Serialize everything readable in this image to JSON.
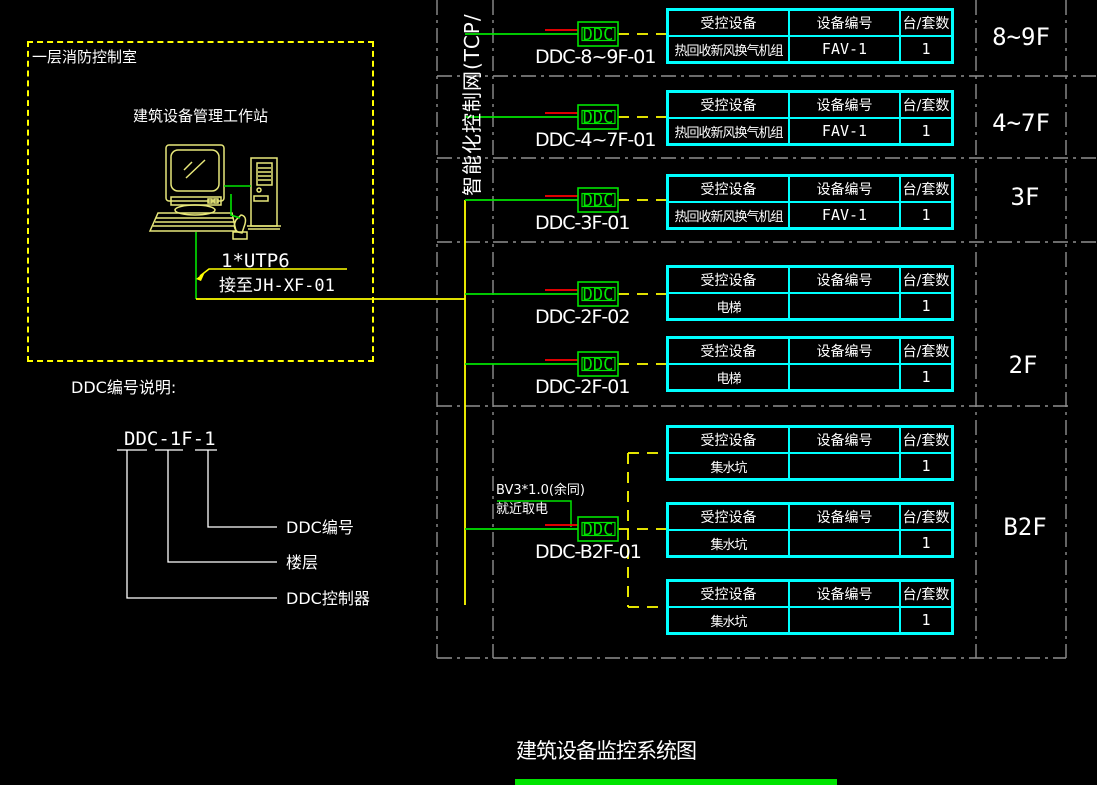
{
  "title_block": {
    "title": "建筑设备监控系统图"
  },
  "control_room": {
    "name": "一层消防控制室",
    "workstation": "建筑设备管理工作站",
    "cable": "1*UTP6",
    "connect_to": "接至JH-XF-01"
  },
  "network": {
    "trunk_label": "智能化控制网(TCP/"
  },
  "legend": {
    "heading": "DDC编号说明:",
    "example": "DDC-1F-1",
    "callouts": [
      "DDC编号",
      "楼层",
      "DDC控制器"
    ]
  },
  "power_note": {
    "line1": "BV3*1.0(余同)",
    "line2": "就近取电"
  },
  "ddc_units": [
    {
      "label": "DDC-8~9F-01",
      "box": "DDC"
    },
    {
      "label": "DDC-4~7F-01",
      "box": "DDC"
    },
    {
      "label": "DDC-3F-01",
      "box": "DDC"
    },
    {
      "label": "DDC-2F-02",
      "box": "DDC"
    },
    {
      "label": "DDC-2F-01",
      "box": "DDC"
    },
    {
      "label": "DDC-B2F-01",
      "box": "DDC"
    }
  ],
  "tables": {
    "header": [
      "受控设备",
      "设备编号",
      "台/套数"
    ],
    "rows": [
      {
        "floor_group": "8~9F",
        "device": "热回收新风换气机组",
        "device_no": "FAV-1",
        "qty": "1"
      },
      {
        "floor_group": "4~7F",
        "device": "热回收新风换气机组",
        "device_no": "FAV-1",
        "qty": "1"
      },
      {
        "floor_group": "3F",
        "device": "热回收新风换气机组",
        "device_no": "FAV-1",
        "qty": "1"
      },
      {
        "floor_group": "2F",
        "device": "电梯",
        "device_no": "",
        "qty": "1"
      },
      {
        "floor_group": "2F",
        "device": "电梯",
        "device_no": "",
        "qty": "1"
      },
      {
        "floor_group": "B2F",
        "device": "集水坑",
        "device_no": "",
        "qty": "1"
      },
      {
        "floor_group": "B2F",
        "device": "集水坑",
        "device_no": "",
        "qty": "1"
      },
      {
        "floor_group": "B2F",
        "device": "集水坑",
        "device_no": "",
        "qty": "1"
      }
    ]
  },
  "floors": [
    "8~9F",
    "4~7F",
    "3F",
    "2F",
    "B2F"
  ],
  "colors": {
    "background": "#000000",
    "line_yellow": "#ffff00",
    "line_green": "#00e400",
    "table_cyan": "#00ffff",
    "text_white": "#ffffff",
    "stub_red": "#ff0000",
    "grid_gray": "#8f8f8f"
  }
}
